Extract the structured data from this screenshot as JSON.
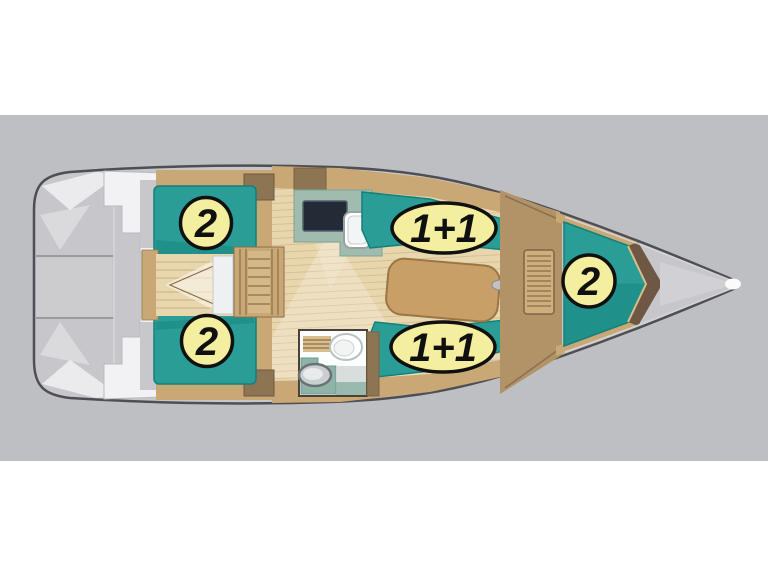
{
  "colors": {
    "page_white": "#ffffff",
    "band_gray": "#bdbfc3",
    "hull_gray": "#c7c7cb",
    "hull_outline": "#4e4e54",
    "cushion_teal": "#2a9d97",
    "cushion_teal_dark": "#14807a",
    "label_yellow": "#f4ef9f",
    "wood_light": "#e8d6ae",
    "wood_mid": "#c9a876",
    "wood_dark": "#8d7452",
    "galley_counter": "#9fbcae",
    "stove_navy": "#232c36"
  },
  "plan": {
    "labels": [
      {
        "id": "aft-cabin-port-berth",
        "shape": "circle",
        "text": "2"
      },
      {
        "id": "aft-cabin-starboard-berth",
        "shape": "circle",
        "text": "2"
      },
      {
        "id": "saloon-port-berth",
        "shape": "ellipse",
        "text": "1+1"
      },
      {
        "id": "saloon-starboard-berth",
        "shape": "ellipse",
        "text": "1+1"
      },
      {
        "id": "fore-cabin-berth",
        "shape": "circle",
        "text": "2"
      }
    ]
  }
}
